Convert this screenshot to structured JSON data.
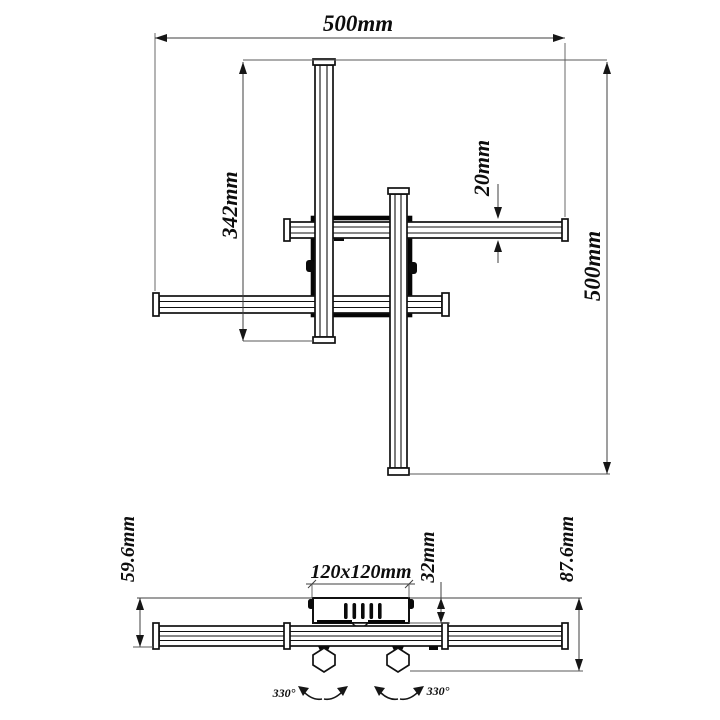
{
  "page": {
    "background": "#ffffff"
  },
  "colors": {
    "part_line": "#111111",
    "dim_line": "#3f3f3f",
    "text": "#0d0d0d"
  },
  "top_view": {
    "dim_overall_width": "500mm",
    "dim_bar_length": "342mm",
    "dim_bar_width": "20mm",
    "dim_overall_depth": "500mm"
  },
  "side_view": {
    "dim_drop_to_bar": "59.6mm",
    "dim_overall_drop": "87.6mm",
    "dim_canopy_size": "120x120mm",
    "dim_canopy_height": "32mm",
    "dim_rotation_left": "330°",
    "dim_rotation_right": "330°"
  }
}
